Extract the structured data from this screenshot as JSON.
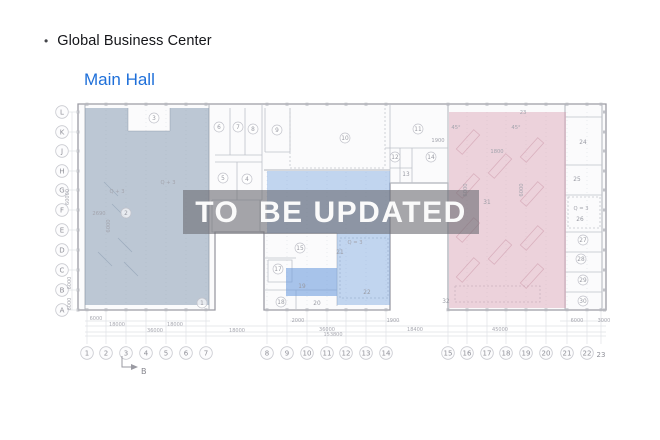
{
  "header": {
    "bullet": "•",
    "title": "Global Business Center",
    "subtitle": "Main Hall"
  },
  "watermark": {
    "text": "TO  BE UPDATED"
  },
  "colors": {
    "accent": "#1e6fd9",
    "zone_left": "#7d93ab",
    "zone_middle": "#6f9fdd",
    "zone_right": "#d895ab",
    "watermark_band": "#6b6b71",
    "watermark_text": "#fafafa"
  },
  "plan": {
    "rows": [
      {
        "label": "L",
        "y": 112
      },
      {
        "label": "K",
        "y": 132
      },
      {
        "label": "J",
        "y": 151
      },
      {
        "label": "H",
        "y": 171
      },
      {
        "label": "G",
        "y": 190
      },
      {
        "label": "F",
        "y": 210
      },
      {
        "label": "E",
        "y": 230
      },
      {
        "label": "D",
        "y": 250
      },
      {
        "label": "C",
        "y": 270
      },
      {
        "label": "B",
        "y": 290
      },
      {
        "label": "A",
        "y": 310
      }
    ],
    "cols": [
      {
        "label": "1",
        "x": 87
      },
      {
        "label": "2",
        "x": 106
      },
      {
        "label": "3",
        "x": 126
      },
      {
        "label": "4",
        "x": 146
      },
      {
        "label": "5",
        "x": 166
      },
      {
        "label": "6",
        "x": 186
      },
      {
        "label": "7",
        "x": 206
      },
      {
        "label": "8",
        "x": 267
      },
      {
        "label": "9",
        "x": 287
      },
      {
        "label": "10",
        "x": 307
      },
      {
        "label": "11",
        "x": 327
      },
      {
        "label": "12",
        "x": 346
      },
      {
        "label": "13",
        "x": 366
      },
      {
        "label": "14",
        "x": 386
      },
      {
        "label": "15",
        "x": 448
      },
      {
        "label": "16",
        "x": 467
      },
      {
        "label": "17",
        "x": 487
      },
      {
        "label": "18",
        "x": 506
      },
      {
        "label": "19",
        "x": 526
      },
      {
        "label": "20",
        "x": 546
      },
      {
        "label": "21",
        "x": 567
      },
      {
        "label": "22",
        "x": 587
      },
      {
        "label": "23",
        "x": 601,
        "nocircle": true
      }
    ],
    "rooms": [
      {
        "n": "1",
        "x": 202,
        "y": 303
      },
      {
        "n": "2",
        "x": 126,
        "y": 213
      },
      {
        "n": "3",
        "x": 154,
        "y": 118
      },
      {
        "n": "4",
        "x": 247,
        "y": 179
      },
      {
        "n": "5",
        "x": 223,
        "y": 178
      },
      {
        "n": "6",
        "x": 219,
        "y": 127
      },
      {
        "n": "7",
        "x": 238,
        "y": 127
      },
      {
        "n": "8",
        "x": 253,
        "y": 129
      },
      {
        "n": "9",
        "x": 277,
        "y": 130
      },
      {
        "n": "10",
        "x": 345,
        "y": 138
      },
      {
        "n": "11",
        "x": 418,
        "y": 129
      },
      {
        "n": "12",
        "x": 395,
        "y": 157
      },
      {
        "n": "13",
        "x": 406,
        "y": 174,
        "plain": true
      },
      {
        "n": "14",
        "x": 431,
        "y": 157
      },
      {
        "n": "15",
        "x": 300,
        "y": 248
      },
      {
        "n": "17",
        "x": 278,
        "y": 269
      },
      {
        "n": "18",
        "x": 281,
        "y": 302
      },
      {
        "n": "19",
        "x": 302,
        "y": 286,
        "plain": true
      },
      {
        "n": "20",
        "x": 317,
        "y": 303,
        "plain": true
      },
      {
        "n": "21",
        "x": 340,
        "y": 252,
        "plain": true
      },
      {
        "n": "22",
        "x": 367,
        "y": 292,
        "plain": true
      },
      {
        "n": "24",
        "x": 583,
        "y": 142,
        "plain": true
      },
      {
        "n": "25",
        "x": 577,
        "y": 179,
        "plain": true
      },
      {
        "n": "26",
        "x": 580,
        "y": 219,
        "plain": true
      },
      {
        "n": "27",
        "x": 583,
        "y": 240
      },
      {
        "n": "28",
        "x": 581,
        "y": 259
      },
      {
        "n": "29",
        "x": 583,
        "y": 280
      },
      {
        "n": "30",
        "x": 583,
        "y": 301
      },
      {
        "n": "31",
        "x": 487,
        "y": 202,
        "plain": true
      },
      {
        "n": "32",
        "x": 446,
        "y": 301,
        "plain": true
      }
    ],
    "annotations": [
      {
        "t": "Q + 3",
        "x": 168,
        "y": 184
      },
      {
        "t": "Q + 3",
        "x": 117,
        "y": 193
      },
      {
        "t": "2690",
        "x": 99,
        "y": 215
      },
      {
        "t": "6000",
        "x": 110,
        "y": 226,
        "v": true
      },
      {
        "t": "Q = 3",
        "x": 355,
        "y": 244
      },
      {
        "t": "Q = 3",
        "x": 581,
        "y": 210
      },
      {
        "t": "23",
        "x": 523,
        "y": 114
      },
      {
        "t": "45°",
        "x": 456,
        "y": 129
      },
      {
        "t": "45°",
        "x": 516,
        "y": 129
      },
      {
        "t": "1900",
        "x": 438,
        "y": 142
      },
      {
        "t": "1800",
        "x": 497,
        "y": 153
      },
      {
        "t": "6000",
        "x": 467,
        "y": 190,
        "v": true
      },
      {
        "t": "6000",
        "x": 523,
        "y": 190,
        "v": true
      }
    ],
    "dims": [
      {
        "t": "6000",
        "x": 96,
        "y": 320
      },
      {
        "t": "2000",
        "x": 298,
        "y": 322
      },
      {
        "t": "1900",
        "x": 393,
        "y": 322
      },
      {
        "t": "6000",
        "x": 577,
        "y": 322
      },
      {
        "t": "3000",
        "x": 604,
        "y": 322
      },
      {
        "t": "18000",
        "x": 117,
        "y": 326
      },
      {
        "t": "18000",
        "x": 175,
        "y": 326
      },
      {
        "t": "36000",
        "x": 155,
        "y": 332
      },
      {
        "t": "18000",
        "x": 237,
        "y": 332
      },
      {
        "t": "36000",
        "x": 327,
        "y": 331
      },
      {
        "t": "18400",
        "x": 415,
        "y": 331
      },
      {
        "t": "45000",
        "x": 500,
        "y": 331
      },
      {
        "t": "153800",
        "x": 333,
        "y": 336
      },
      {
        "t": "60000",
        "x": 69,
        "y": 197,
        "v": true
      },
      {
        "t": "6000",
        "x": 71,
        "y": 283,
        "v": true
      },
      {
        "t": "6000",
        "x": 71,
        "y": 304,
        "v": true
      }
    ],
    "section_label": "B"
  }
}
